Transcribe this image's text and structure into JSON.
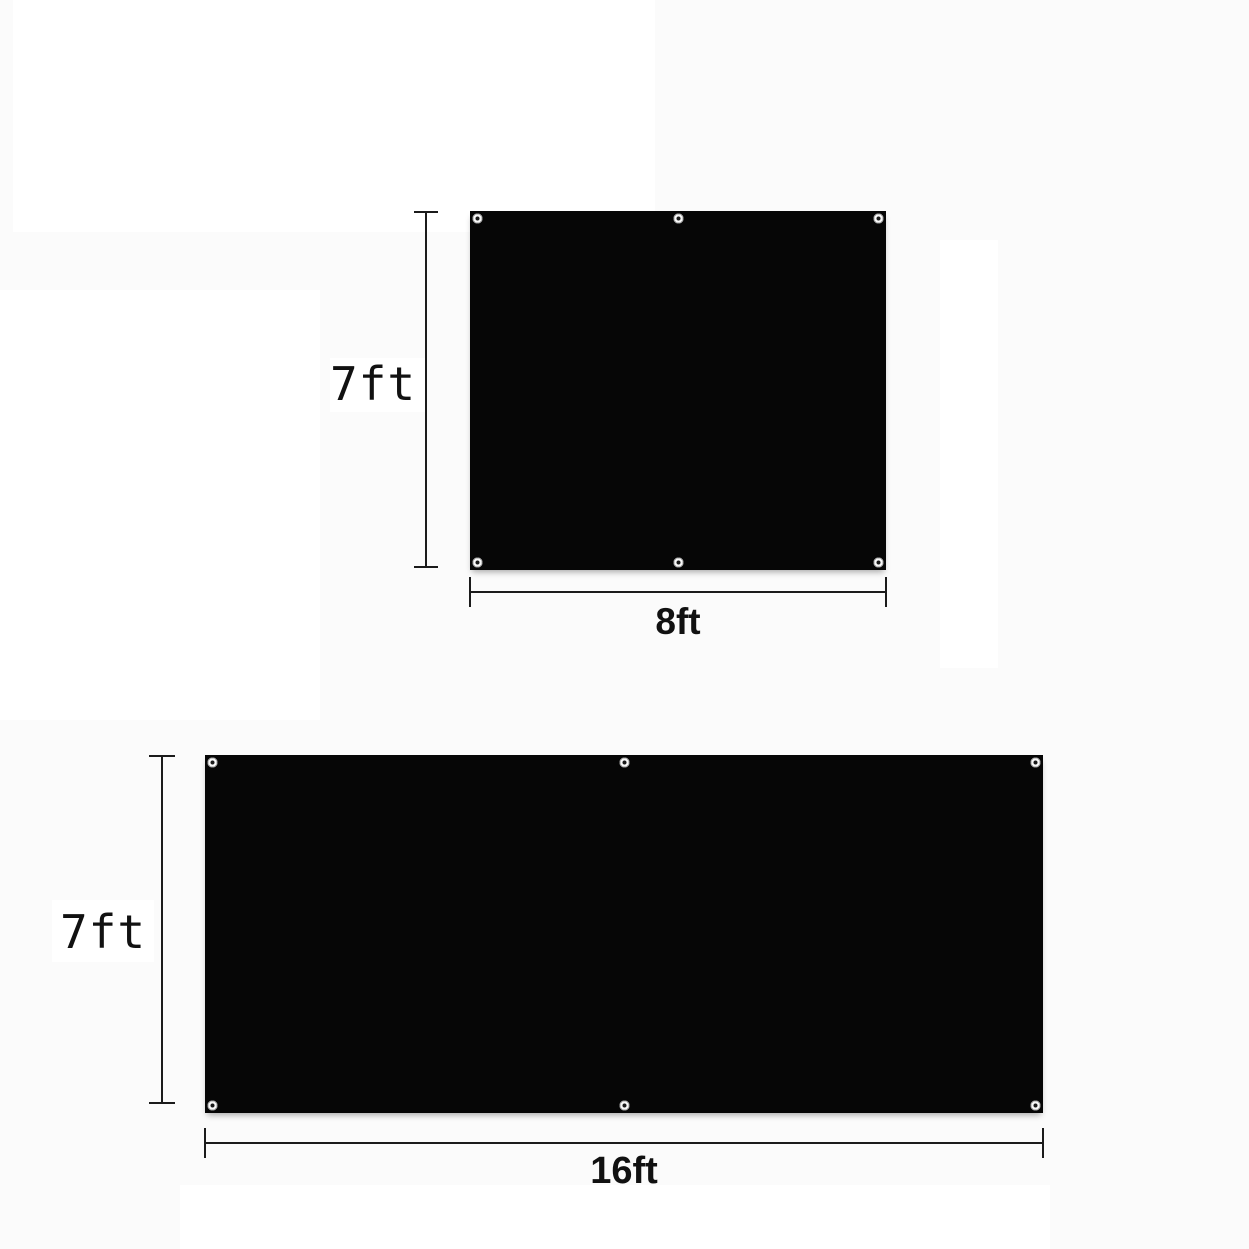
{
  "colors": {
    "background": "#fbfbfb",
    "patch": "#ffffff",
    "tarp_fill": "#060606",
    "line_color": "#1b1b1b",
    "text_color": "#111111"
  },
  "panels": [
    {
      "height_label": "7ft",
      "width_label": "8ft",
      "grommet_count": 6,
      "grommet_layout": "corners plus top-center and bottom-center"
    },
    {
      "height_label": "7ft",
      "width_label": "16ft",
      "grommet_count": 6,
      "grommet_layout": "corners plus top-center and bottom-center"
    }
  ],
  "icons": {
    "grommet": "white eyelet ring with dark center hole"
  }
}
